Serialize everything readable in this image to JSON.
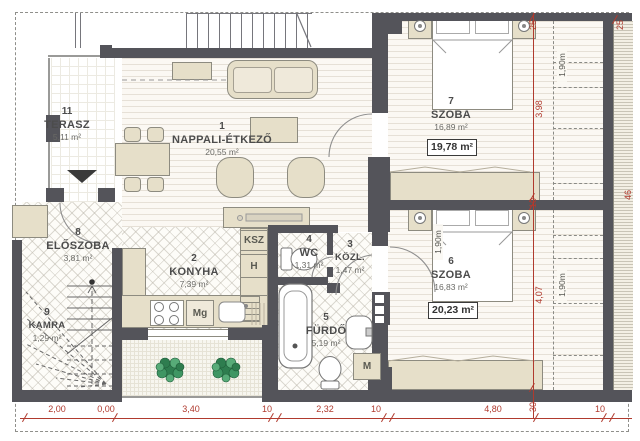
{
  "rooms": [
    {
      "id": "nappali-etkezo",
      "number": "1",
      "name": "NAPPALI-ÉTKEZŐ",
      "area": "20,55 m²"
    },
    {
      "id": "konyha",
      "number": "2",
      "name": "KONYHA",
      "area": "7,39 m²"
    },
    {
      "id": "kozlekedo",
      "number": "3",
      "name": "KÖZL.",
      "area": "1,47 m²"
    },
    {
      "id": "wc",
      "number": "4",
      "name": "WC",
      "area": "1,31 m²"
    },
    {
      "id": "furdo",
      "number": "5",
      "name": "FÜRDŐ",
      "area": "5,19 m²"
    },
    {
      "id": "szoba-6",
      "number": "6",
      "name": "SZOBA",
      "area": "16,83 m²",
      "gross_area": "20,23 m²"
    },
    {
      "id": "szoba-7",
      "number": "7",
      "name": "SZOBA",
      "area": "16,89 m²",
      "gross_area": "19,78 m²"
    },
    {
      "id": "eloszoba",
      "number": "8",
      "name": "ELŐSZOBA",
      "area": "3,81 m²"
    },
    {
      "id": "kamra",
      "number": "9",
      "name": "KAMRA",
      "area": "1,29 m²"
    },
    {
      "id": "terasz",
      "number": "11",
      "name": "TERASZ",
      "area": "5,11 m²"
    }
  ],
  "fixture_labels": {
    "ksz": "KSZ",
    "h": "H",
    "mg": "Mg",
    "m": "M"
  },
  "dimensions": {
    "bottom_chain": [
      "2,00",
      "0,00",
      "3,40",
      "10",
      "2,32",
      "10",
      "4,80",
      "30",
      "10"
    ],
    "right_chain": [
      "25",
      "3,98",
      "10",
      "4,07"
    ],
    "edge_marks": [
      "25",
      "46"
    ],
    "headroom_labels": [
      "1,90m",
      "1,90m",
      "1,90m"
    ]
  },
  "colors": {
    "wall": "#54545a",
    "furniture": "#e6dfc9",
    "dimension_red": "#b03a2e",
    "plant_green": "#2e7d4f",
    "floor": "#fbf8f3"
  }
}
